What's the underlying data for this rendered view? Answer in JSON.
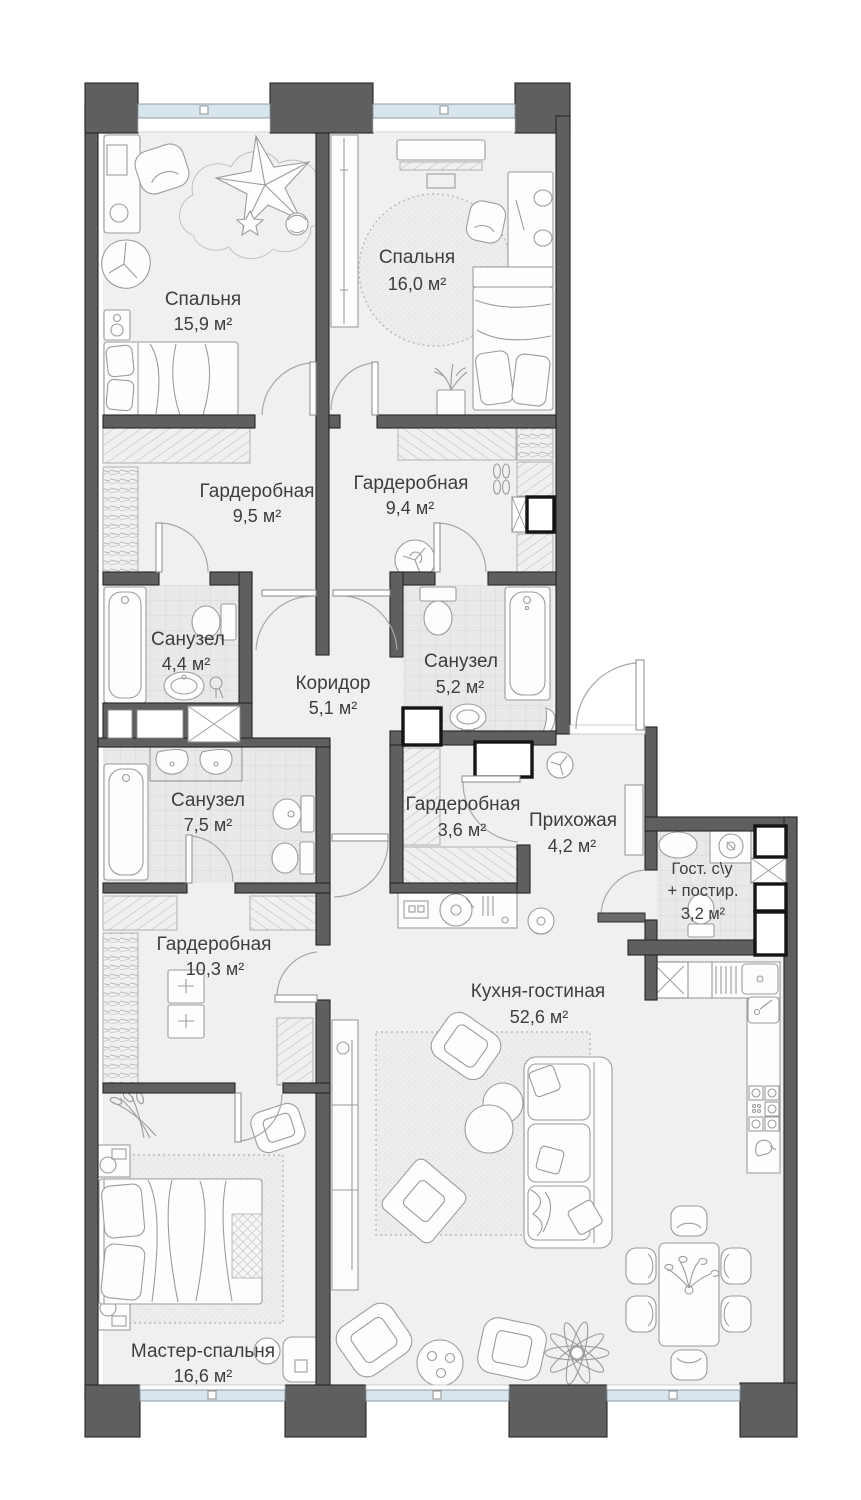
{
  "rooms": {
    "bedroom1": {
      "name": "Спальня",
      "area": "15,9 м²"
    },
    "bedroom2": {
      "name": "Спальня",
      "area": "16,0 м²"
    },
    "wardrobe95": {
      "name": "Гардеробная",
      "area": "9,5 м²"
    },
    "wardrobe94": {
      "name": "Гардеробная",
      "area": "9,4 м²"
    },
    "bath44": {
      "name": "Санузел",
      "area": "4,4 м²"
    },
    "bath52": {
      "name": "Санузел",
      "area": "5,2 м²"
    },
    "corridor": {
      "name": "Коридор",
      "area": "5,1 м²"
    },
    "bath75": {
      "name": "Санузел",
      "area": "7,5 м²"
    },
    "wardrobe36": {
      "name": "Гардеробная",
      "area": "3,6 м²"
    },
    "hallway": {
      "name": "Прихожая",
      "area": "4,2 м²"
    },
    "guest": {
      "name": "Гост. с\\у",
      "name2": "+ постир.",
      "area": "3,2 м²"
    },
    "wardrobe103": {
      "name": "Гардеробная",
      "area": "10,3 м²"
    },
    "kitchen": {
      "name": "Кухня-гостиная",
      "area": "52,6 м²"
    },
    "master": {
      "name": "Мастер-спальня",
      "area": "16,6 м²"
    }
  },
  "colors": {
    "wall": "#5f5f5f",
    "wallline": "#262626",
    "floor": "#f0f0ef",
    "tilebg": "#e9e9e9",
    "window": "#d9e5ed",
    "furn": "#9c9c9c",
    "text": "#3e3e3e"
  }
}
